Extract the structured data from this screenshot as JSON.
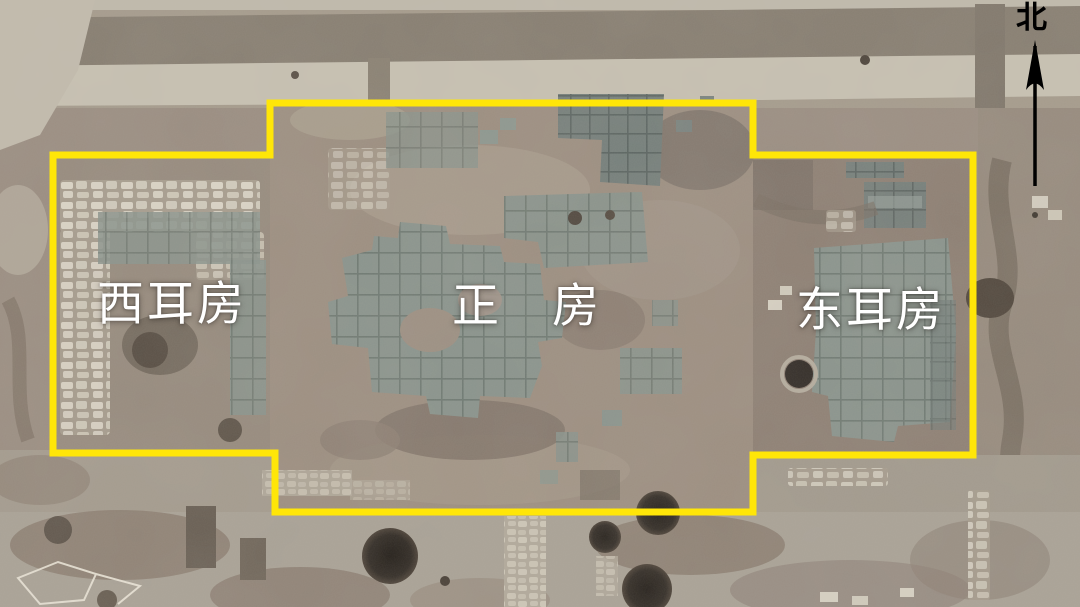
{
  "annotations": {
    "room_labels": [
      {
        "id": "west-ear-room",
        "text": "西耳房"
      },
      {
        "id": "main-room",
        "text": "正　房"
      },
      {
        "id": "east-ear-room",
        "text": "东耳房"
      }
    ],
    "compass": {
      "text": "北"
    },
    "colors": {
      "outline": "#ffe608",
      "room_label_text": "#ffffff",
      "compass_text": "#000000"
    }
  }
}
